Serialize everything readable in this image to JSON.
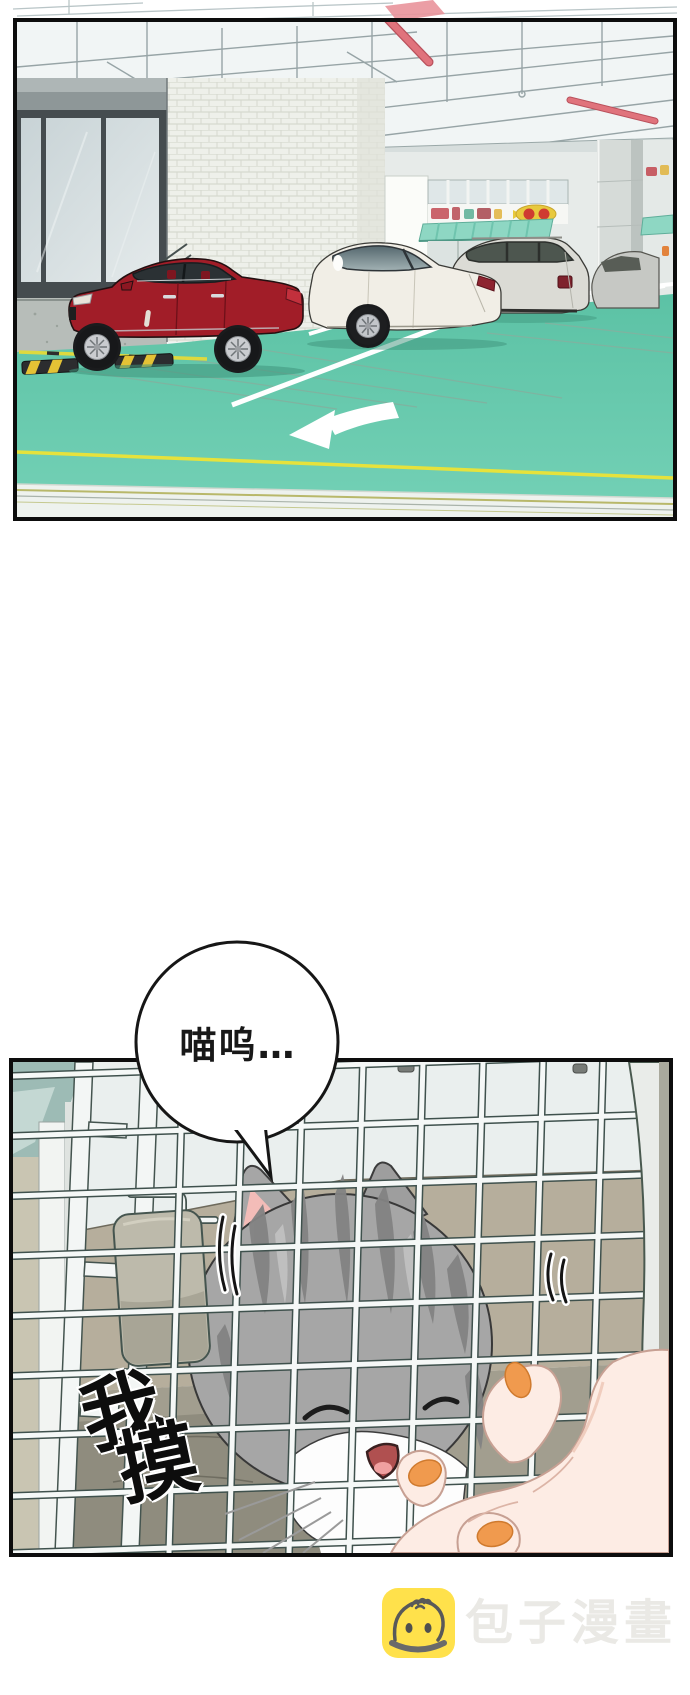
{
  "comic": {
    "speech_bubble": {
      "text": "喵呜…"
    },
    "sfx": {
      "text": "我摸",
      "char1": "我",
      "char2": "摸"
    },
    "panel1": {
      "name": "parking-garage-scene",
      "colors": {
        "floor_teal": "#64c8ac",
        "red_car": "#a11d28",
        "white_car": "#f1eee6",
        "gray_suv": "#dbdbd5",
        "ceiling_pipes_red": "#e0737c",
        "awning_teal": "#8ed7c3",
        "yellow_line": "#e6e23c",
        "arrow_white": "#ffffff"
      }
    },
    "panel2": {
      "name": "cat-in-carrier-scene",
      "colors": {
        "cage_bar_fill": "#f5f8f7",
        "cage_bar_outline": "#3f514d",
        "carrier_back_wall": "#b6ae9c",
        "cat_fur_gray": "#a6a6a6",
        "ear_inner_pink": "#f3bcb8",
        "nail_orange": "#f09a4e",
        "latch_beige": "#bdbaab"
      }
    }
  },
  "watermark": {
    "icon": "baozi-bun-icon",
    "icon_bg_color": "#ffe14b",
    "text": "包子漫畫",
    "text_color": "#eae9e5"
  }
}
